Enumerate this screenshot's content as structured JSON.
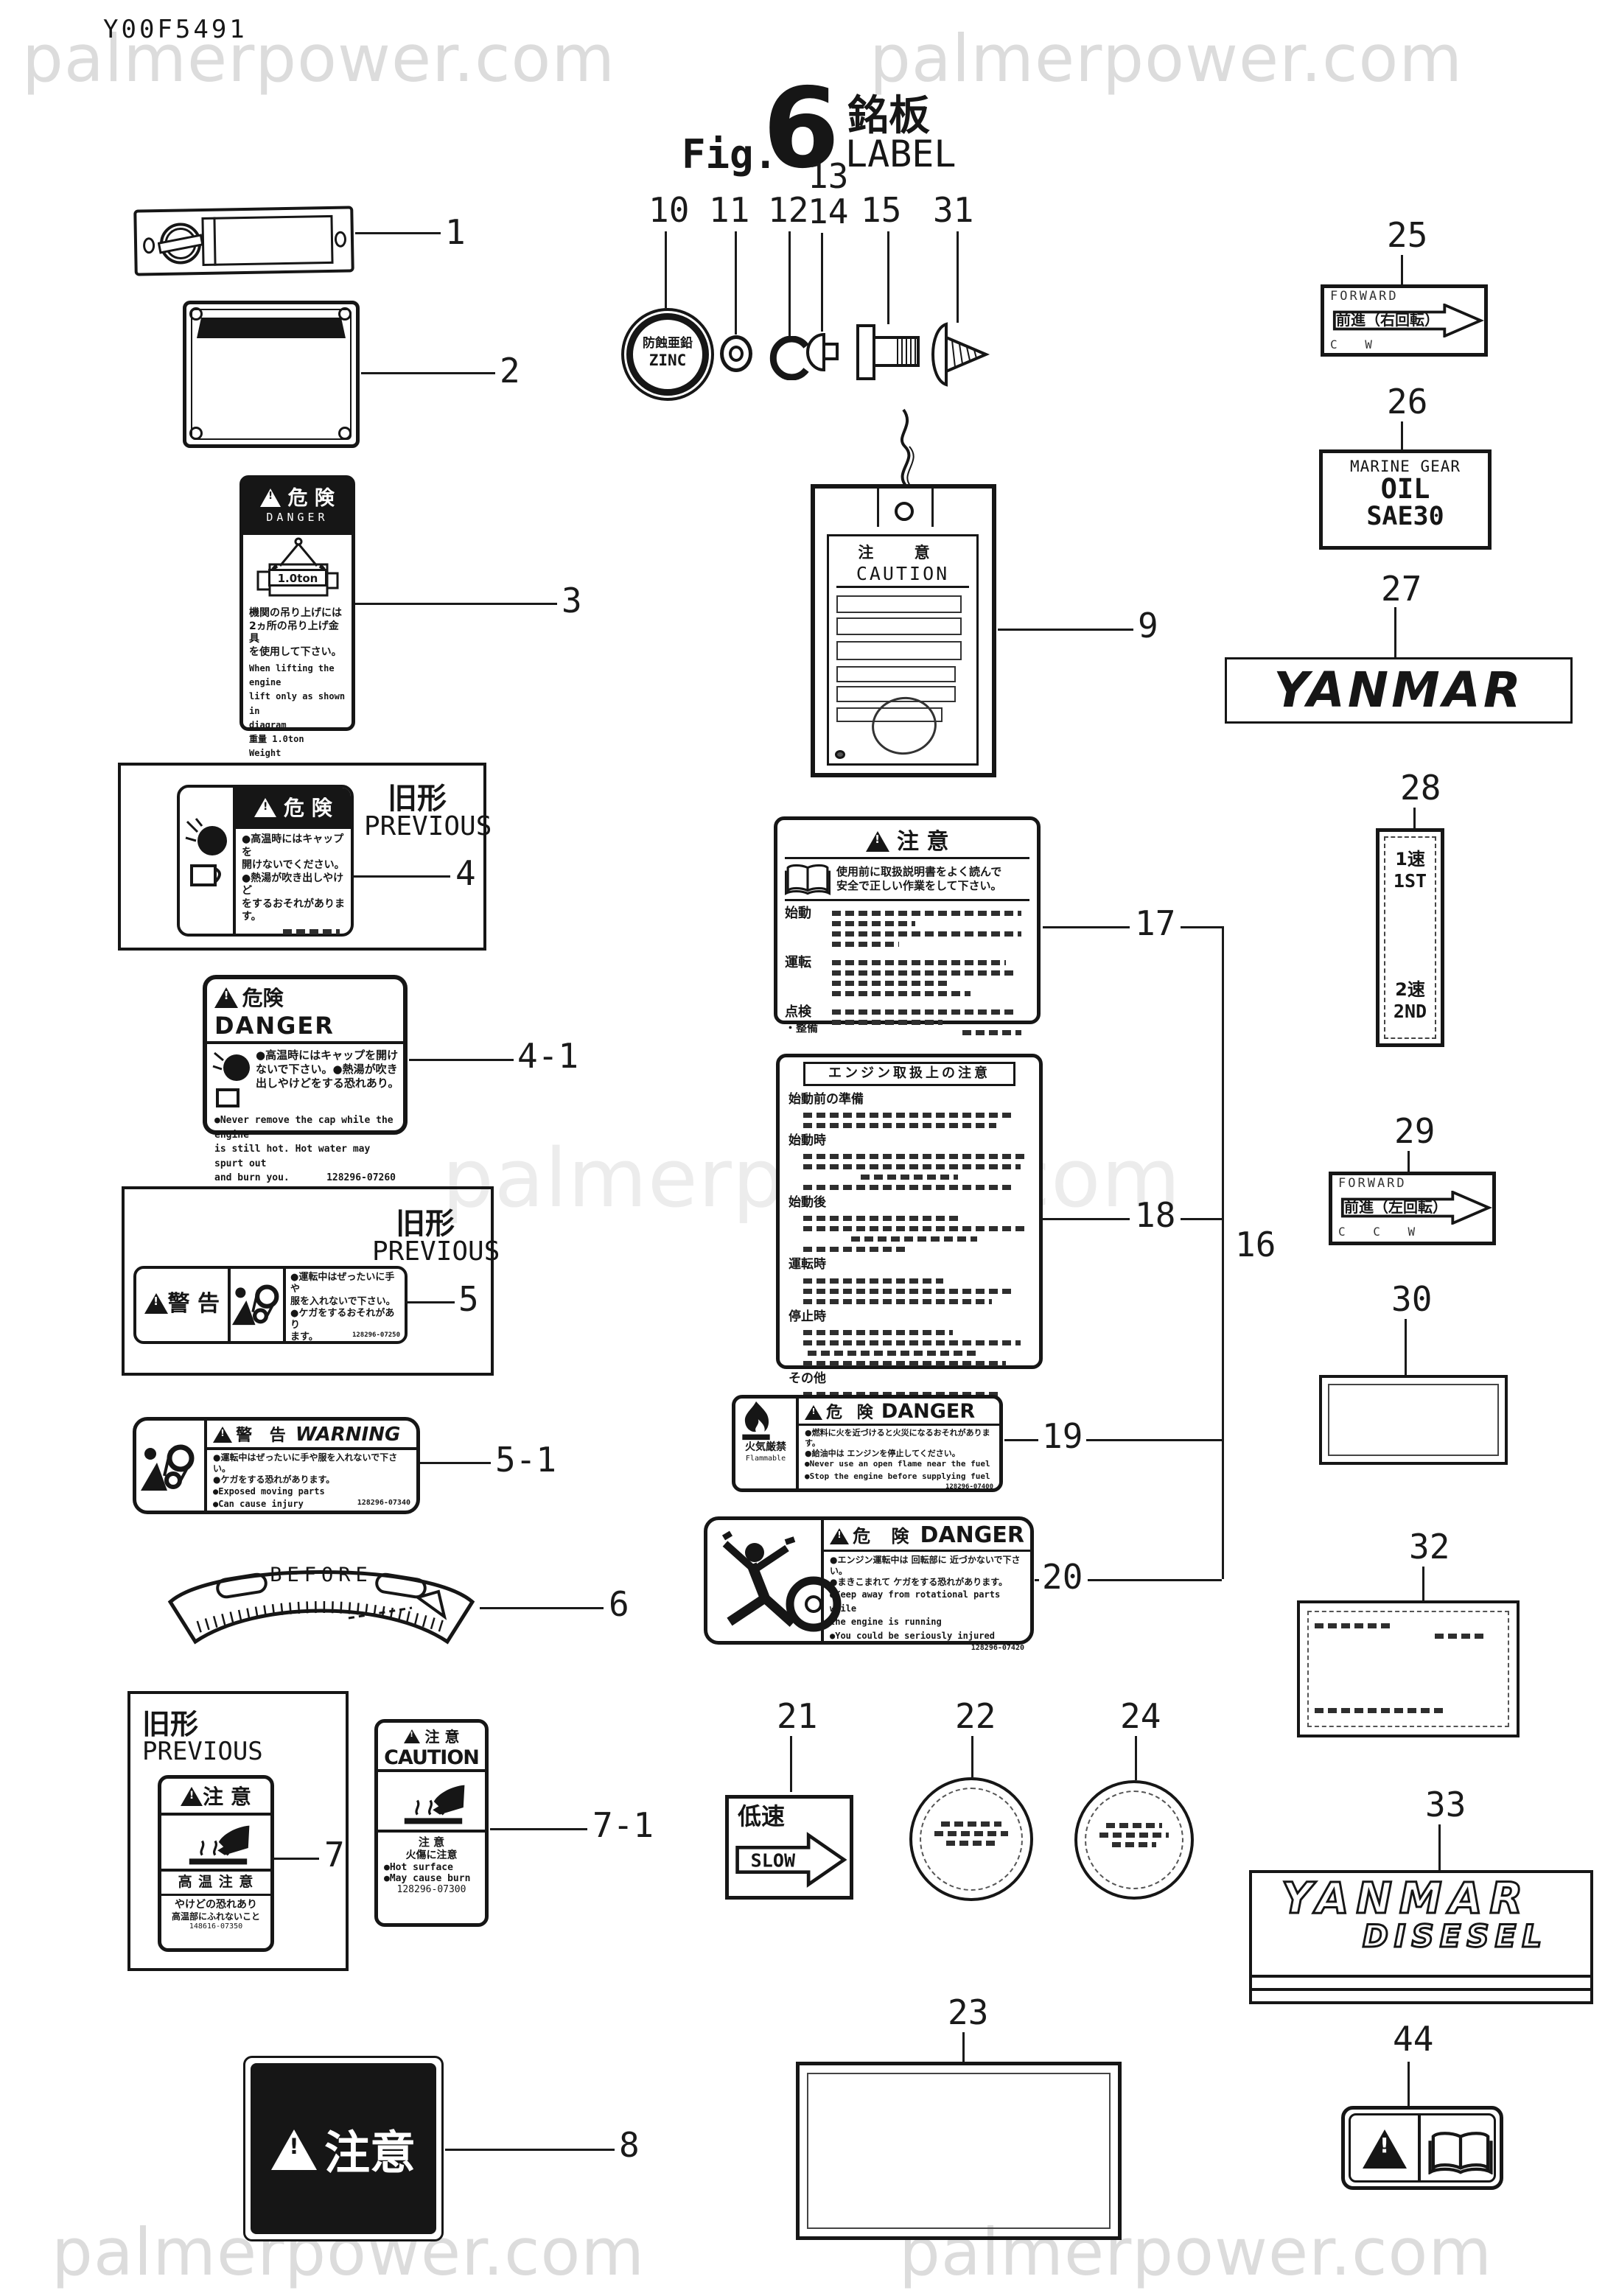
{
  "page": {
    "code": "Y00F5491",
    "fig_prefix": "Fig.",
    "fig_number": "6",
    "title_jp": "銘板",
    "title_en": "LABEL",
    "watermark": "palmerpower.com"
  },
  "callouts": {
    "c1": "1",
    "c2": "2",
    "c3": "3",
    "c4": "4",
    "c4_1": "4-1",
    "c5": "5",
    "c5_1": "5-1",
    "c6": "6",
    "c7": "7",
    "c7_1": "7-1",
    "c8": "8",
    "c9": "9",
    "c10": "10",
    "c11": "11",
    "c12": "12",
    "c13": "13",
    "c14": "14",
    "c15": "15",
    "c16": "16",
    "c17": "17",
    "c18": "18",
    "c19": "19",
    "c20": "20",
    "c21": "21",
    "c22": "22",
    "c23": "23",
    "c24": "24",
    "c25": "25",
    "c26": "26",
    "c27": "27",
    "c28": "28",
    "c29": "29",
    "c30": "30",
    "c31": "31",
    "c32": "32",
    "c33": "33",
    "c44": "44"
  },
  "label3": {
    "header_jp": "危 険",
    "header_en": "DANGER",
    "hoist": "1.0ton",
    "jp1": "機関の吊り上げには",
    "jp2": "2ヵ所の吊り上げ金具",
    "jp3": "を使用して下さい。",
    "en1": "When lifting the engine",
    "en2": "lift only as shown in",
    "en3": "diagram",
    "wt_jp": "重量 1.0ton",
    "wt_en": "Weight"
  },
  "label4": {
    "prev_jp": "旧形",
    "prev_en": "PREVIOUS",
    "header_jp": "危 険",
    "jp1": "●高温時にはキャップを",
    "jp2": "開けないでください。",
    "jp3": "●熱湯が吹き出しやけど",
    "jp4": "をするおそれがあります。"
  },
  "label4_1": {
    "header_jp": "危険",
    "header_en": "DANGER",
    "jp1": "●高温時にはキャップを開け",
    "jp2": "ないで下さい。●熱湯が吹き",
    "jp3": "出しやけどをする恐れあり。",
    "en1": "●Never remove the cap while the engine",
    "en2": "is still hot. Hot water may spurt out",
    "en3": "and burn you.",
    "code": "128296-07260"
  },
  "label5": {
    "prev_jp": "旧形",
    "prev_en": "PREVIOUS",
    "header": "警 告",
    "jp1": "●運転中はぜったいに手や",
    "jp2": "服を入れないで下さい。",
    "jp3": "●ケガをするおそれがあり",
    "jp4": "ます。",
    "code": "128296-07250"
  },
  "label5_1": {
    "header_jp": "警 告",
    "header_en": "WARNING",
    "jp1": "●運転中はぜったいに手や服を入れないで下さい。",
    "jp2": "●ケガをする恐れがあります。",
    "en1": "●Exposed moving parts",
    "en2": "●Can cause injury",
    "code": "128296-07340"
  },
  "label6": {
    "text": "BEFORE"
  },
  "label7": {
    "prev_jp": "旧形",
    "prev_en": "PREVIOUS",
    "header": "注 意",
    "band": "高 温 注 意",
    "jp1": "やけどの恐れあり",
    "jp2": "高温部にふれないこと",
    "code": "148616-07350"
  },
  "label7_1": {
    "header_jp": "注 意",
    "header_en": "CAUTION",
    "jp1": "注  意",
    "jp2": "火傷に注意",
    "en1": "●Hot surface",
    "en2": "●May cause burn",
    "code": "128296-07300"
  },
  "label8": {
    "text": "注意"
  },
  "label9": {
    "header_jp": "注 意",
    "header_en": "CAUTION"
  },
  "label10": {
    "jp": "防蝕亜鉛",
    "en": "ZINC"
  },
  "label17": {
    "header": "注 意",
    "intro1": "使用前に取扱説明書をよく読んで",
    "intro2": "安全で正しい作業をして下さい。",
    "s1": "始動",
    "s2": "運転",
    "s3": "点検",
    "s3b": "・整備"
  },
  "label18": {
    "title": "エンジン取扱上の注意",
    "s1": "始動前の準備",
    "s2": "始動時",
    "s3": "始動後",
    "s4": "運転時",
    "s5": "停止時",
    "s6": "その他"
  },
  "label19": {
    "header_jp": "危 険",
    "header_en": "DANGER",
    "side_jp": "火気厳禁",
    "side_en": "Flammable",
    "jp1": "●燃料に火を近づけると火災になるおそれがあります。",
    "jp2": "●給油中は エンジンを停止してください。",
    "en1": "●Never use an open flame near the fuel",
    "en2": "●Stop the engine before supplying fuel",
    "code": "128296-07400"
  },
  "label20": {
    "header_jp": "危 険",
    "header_en": "DANGER",
    "jp1": "●エンジン運転中は 回転部に 近づかないで下さい。",
    "jp2": "●まきこまれて ケガをする恐れがあります。",
    "en1": "●Keep away from rotational parts while",
    "en2": "the engine is running",
    "en3": "●You could be seriously injured",
    "code": "128296-07420"
  },
  "label21": {
    "jp": "低速",
    "en": "SLOW"
  },
  "label25": {
    "top": "FORWARD",
    "mid": "前進（右回転）",
    "bottom": "C W"
  },
  "label26": {
    "l1": "MARINE GEAR",
    "l2": "OIL",
    "l3": "SAE30"
  },
  "label27": {
    "text": "YANMAR"
  },
  "label28": {
    "t1": "1速",
    "t2": "1ST",
    "b1": "2速",
    "b2": "2ND"
  },
  "label29": {
    "top": "FORWARD",
    "mid": "前進（左回転）",
    "bottom": "C C W"
  },
  "label33": {
    "l1": "YANMAR",
    "l2": "DISESEL"
  }
}
